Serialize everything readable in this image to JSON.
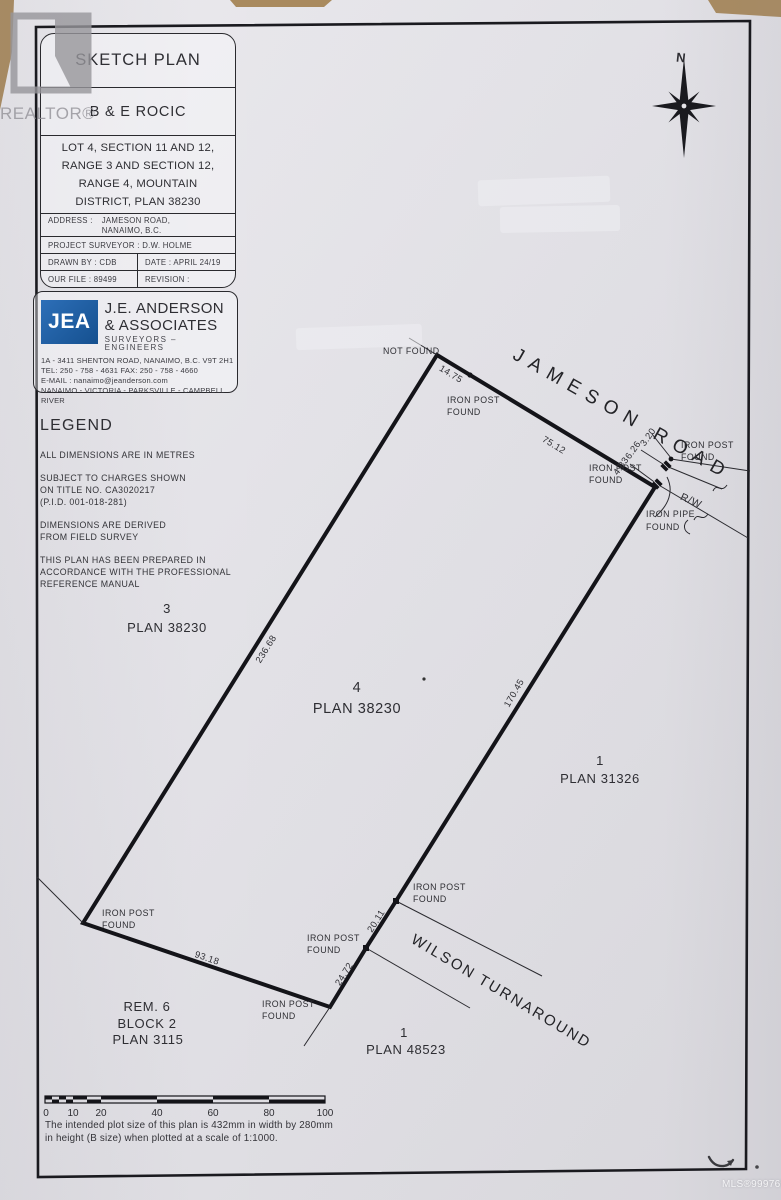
{
  "page": {
    "realtor_watermark": "REALTOR®",
    "mls_watermark": "MLS®999769"
  },
  "title_block": {
    "title": "SKETCH PLAN",
    "client": "B & E ROCIC",
    "legal_lines": [
      "LOT 4, SECTION 11 AND 12,",
      "RANGE 3 AND SECTION 12,",
      "RANGE 4, MOUNTAIN",
      "DISTRICT, PLAN 38230"
    ],
    "address_label": "ADDRESS :",
    "address_lines": [
      "JAMESON ROAD,",
      "NANAIMO, B.C."
    ],
    "surveyor": "PROJECT SURVEYOR : D.W. HOLME",
    "drawn_by": "DRAWN BY : CDB",
    "date": "DATE : APRIL 24/19",
    "file_no": "OUR FILE : 89499",
    "revision": "REVISION :"
  },
  "firm": {
    "logo_text": "JEA",
    "logo_color": "#1d5fa8",
    "name_line1": "J.E. ANDERSON",
    "name_line2": "& ASSOCIATES",
    "tagline": "SURVEYORS – ENGINEERS",
    "info_lines": [
      "1A - 3411 SHENTON ROAD, NANAIMO, B.C. V9T 2H1",
      "TEL: 250 - 758 - 4631 FAX: 250 - 758 - 4660",
      "E-MAIL : nanaimo@jeanderson.com",
      "NANAIMO - VICTORIA - PARKSVILLE - CAMPBELL RIVER"
    ]
  },
  "legend": {
    "heading": "LEGEND",
    "note1": "ALL DIMENSIONS ARE IN METRES",
    "note2_lines": [
      "SUBJECT TO CHARGES SHOWN",
      "ON TITLE NO. CA3020217",
      "(P.I.D. 001-018-281)"
    ],
    "note3_lines": [
      "DIMENSIONS ARE DERIVED",
      "FROM FIELD SURVEY"
    ],
    "note4_lines": [
      "THIS PLAN HAS BEEN PREPARED IN",
      "ACCORDANCE WITH THE PROFESSIONAL",
      "REFERENCE MANUAL"
    ]
  },
  "compass": {
    "north": "N"
  },
  "plan": {
    "roads": {
      "jameson": "JAMESON ROAD",
      "wilson": "WILSON TURNAROUND",
      "right_of_way": "R/W"
    },
    "dims": {
      "d14_75": "14.75",
      "d75_12": "75.12",
      "d236_68": "236.68",
      "d170_45": "170.45",
      "d20_11": "20.11",
      "d24_72": "24.72",
      "d93_18": "93.18",
      "d4_83": "4.83",
      "d6_26": "6.26",
      "d3_20": "3.20"
    },
    "labels": {
      "not_found": "NOT FOUND",
      "iron_post": "IRON POST",
      "iron_pipe": "IRON PIPE",
      "found": "FOUND"
    },
    "parcels": {
      "lot3": {
        "num": "3",
        "plan": "PLAN 38230"
      },
      "lot4": {
        "num": "4",
        "plan": "PLAN 38230"
      },
      "lot1_east": {
        "num": "1",
        "plan": "PLAN 31326"
      },
      "lot1_south": {
        "num": "1",
        "plan": "PLAN 48523"
      },
      "rem6": {
        "line1": "REM. 6",
        "line2": "BLOCK 2",
        "line3": "PLAN 3115"
      }
    }
  },
  "scale_bar": {
    "ticks": [
      "0",
      "10",
      "20",
      "40",
      "60",
      "80",
      "100"
    ],
    "note_lines": [
      "The intended plot size of this plan is 432mm in width by 280mm",
      "in height (B size) when plotted at a scale of 1:1000."
    ]
  }
}
